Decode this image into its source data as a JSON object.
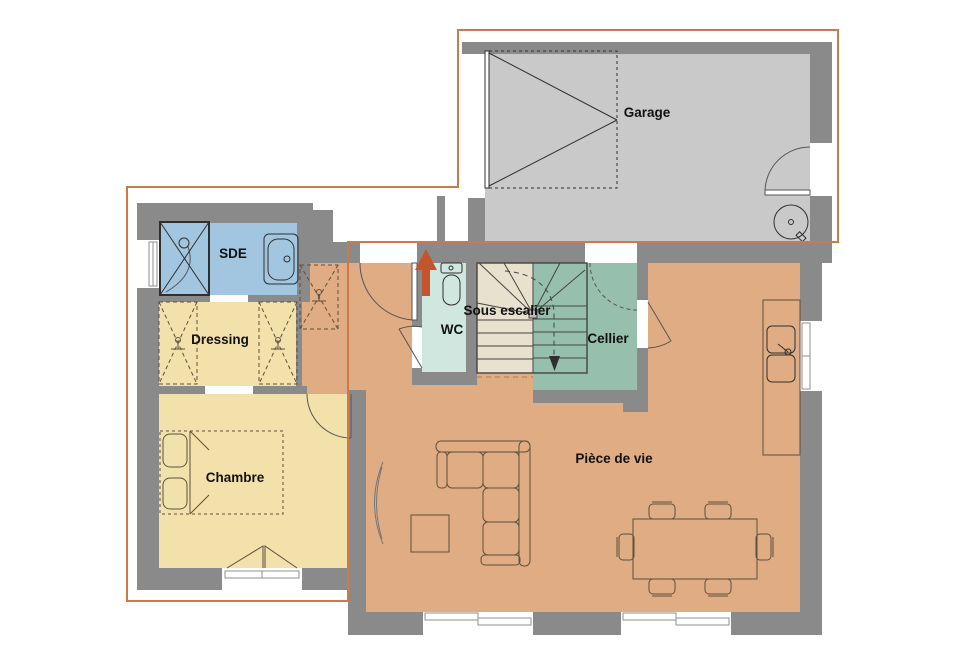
{
  "plan": {
    "rooms": {
      "garage": {
        "label": "Garage",
        "color": "#c9c9c9"
      },
      "sde": {
        "label": "SDE",
        "color": "#a3c6e0"
      },
      "dressing": {
        "label": "Dressing",
        "color": "#f3e1ac"
      },
      "chambre": {
        "label": "Chambre",
        "color": "#f3e1ac"
      },
      "wc": {
        "label": "WC",
        "color": "#cfe7df"
      },
      "sous_escalier": {
        "label": "Sous escalier",
        "color": "#e7e1cd"
      },
      "cellier": {
        "label": "Cellier",
        "color": "#96bfae"
      },
      "piece_de_vie": {
        "label": "Pièce de vie",
        "color": "#dfac84"
      }
    },
    "colors": {
      "background": "#ffffff",
      "wall": "#8a8a8a",
      "upper_floor_outline": "#cc7a4a",
      "entrance_arrow": "#c2552c",
      "furniture_stroke": "#5f4f3d",
      "fixture_stroke": "#2f2f2f",
      "stair_stroke": "#444444",
      "door_stroke": "#555555",
      "window_frame": "#8f8f8f",
      "understairs_dash": "#a97c50",
      "label_text": "#111111"
    }
  }
}
